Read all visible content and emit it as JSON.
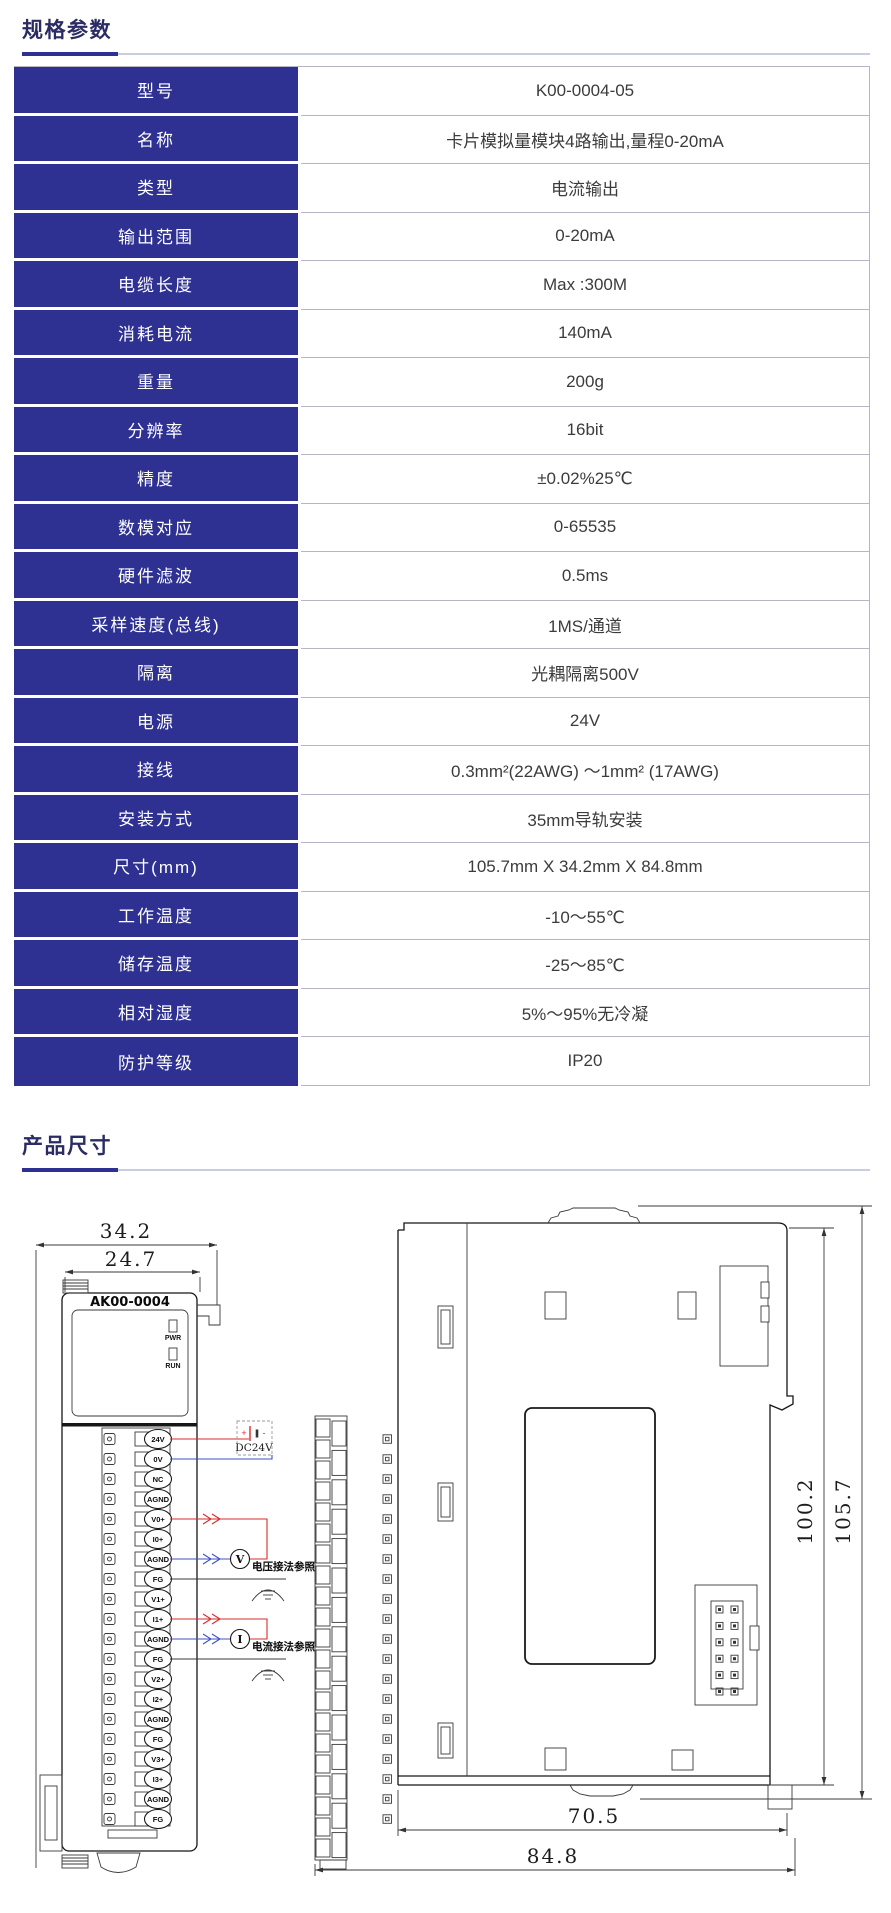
{
  "page": {
    "background": "#ffffff",
    "accent_blue": "#2e3192",
    "grid_line_gray": "#b4b6c4",
    "wire_red": "#d92b2b",
    "wire_blue": "#3f51c1"
  },
  "sections": {
    "specs": {
      "title": "规格参数"
    },
    "dimensions": {
      "title": "产品尺寸"
    }
  },
  "spec_table": {
    "rows": [
      {
        "label": "型号",
        "value": "K00-0004-05"
      },
      {
        "label": "名称",
        "value": "卡片模拟量模块4路输出,量程0-20mA"
      },
      {
        "label": "类型",
        "value": "电流输出"
      },
      {
        "label": "输出范围",
        "value": "0-20mA"
      },
      {
        "label": "电缆长度",
        "value": "Max :300M"
      },
      {
        "label": "消耗电流",
        "value": "140mA"
      },
      {
        "label": "重量",
        "value": "200g"
      },
      {
        "label": "分辨率",
        "value": "16bit"
      },
      {
        "label": "精度",
        "value": "±0.02%25℃"
      },
      {
        "label": "数模对应",
        "value": "0-65535"
      },
      {
        "label": "硬件滤波",
        "value": "0.5ms"
      },
      {
        "label": "采样速度(总线)",
        "value": "1MS/通道"
      },
      {
        "label": "隔离",
        "value": "光耦隔离500V"
      },
      {
        "label": "电源",
        "value": "24V"
      },
      {
        "label": "接线",
        "value": "0.3mm²(22AWG) ～1mm² (17AWG)"
      },
      {
        "label": "安装方式",
        "value": "35mm导轨安装"
      },
      {
        "label": "尺寸(mm)",
        "value": "105.7mm X 34.2mm X 84.8mm"
      },
      {
        "label": "工作温度",
        "value": "-10～55℃"
      },
      {
        "label": "储存温度",
        "value": "-25～85℃"
      },
      {
        "label": "相对湿度",
        "value": "5%～95%无冷凝"
      },
      {
        "label": "防护等级",
        "value": "IP20"
      }
    ]
  },
  "drawing": {
    "front_view": {
      "dim_outer": "34.2",
      "dim_inner": "24.7",
      "model_label": "AK00-0004",
      "led_pwr": "PWR",
      "led_run": "RUN",
      "terminals": [
        "24V",
        "0V",
        "NC",
        "AGND",
        "V0+",
        "I0+",
        "AGND",
        "FG",
        "V1+",
        "I1+",
        "AGND",
        "FG",
        "V2+",
        "I2+",
        "AGND",
        "FG",
        "V3+",
        "I3+",
        "AGND",
        "FG"
      ],
      "power_label": "DC24V",
      "power_plus": "+",
      "power_minus": "-",
      "meter_voltage": "V",
      "meter_current": "I",
      "note_voltage": "电压接法参照",
      "note_current": "电流接法参照"
    },
    "side_view": {
      "dim_height_inner": "100.2",
      "dim_height_outer": "105.7",
      "dim_depth_inner": "70.5",
      "dim_depth_outer": "84.8"
    }
  }
}
